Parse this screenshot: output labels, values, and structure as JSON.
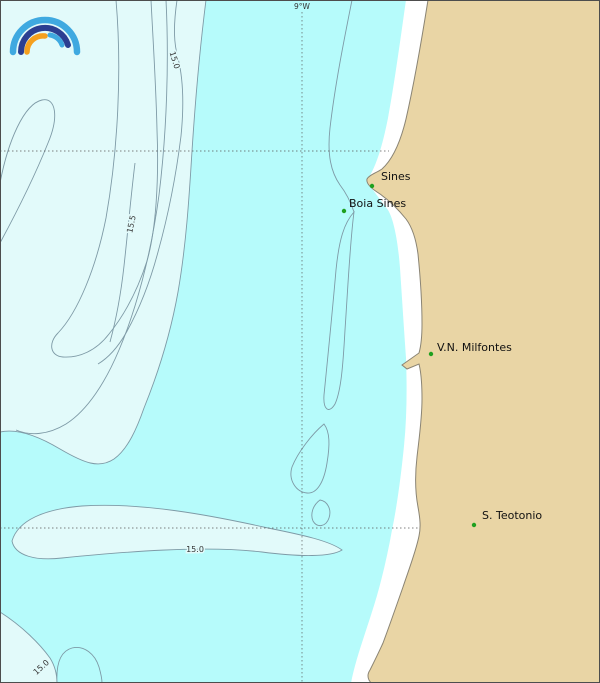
{
  "meridian_label": "9°W",
  "places": [
    {
      "name": "Sines"
    },
    {
      "name": "Boia Sines"
    },
    {
      "name": "V.N. Milfontes"
    },
    {
      "name": "S. Teotonio"
    }
  ],
  "contour_labels": [
    {
      "value": "15.0"
    },
    {
      "value": "15.5"
    },
    {
      "value": "15.0"
    },
    {
      "value": "15.0"
    }
  ],
  "colors": {
    "sea": "#b6fbfb",
    "sea_light": "#e2fafa",
    "land": "#e9d5a5",
    "coast_gap": "#ffffff",
    "coastline": "#8a8474",
    "contour_line": "#7e9aa6",
    "grid_line": "#555555",
    "marker_green": "#1fa01f",
    "frame": "#4d4d4d",
    "logo_light_blue": "#3fa9e0",
    "logo_dark_blue": "#2b3e91",
    "logo_orange": "#f5a01e"
  }
}
